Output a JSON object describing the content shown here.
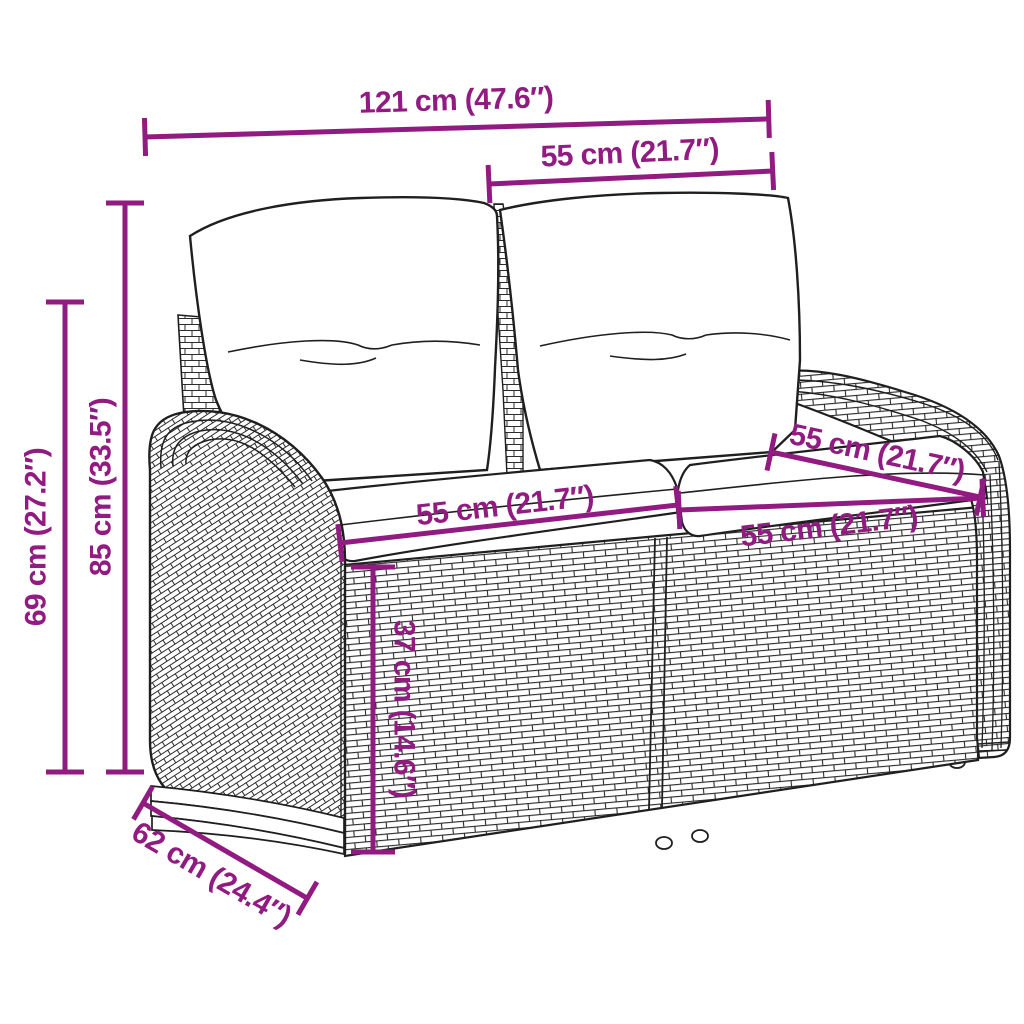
{
  "accent_color": "#911B80",
  "line_color": "#1f1f1f",
  "figure": {
    "subject": "garden-bench-line-drawing"
  },
  "dimensions": {
    "overall_width": "121 cm (47.6″)",
    "backrest_width": "55 cm (21.7″)",
    "total_height": "85 cm (33.5″)",
    "arm_height": "69 cm (27.2″)",
    "seat_width_left": "55 cm (21.7″)",
    "seat_width_right": "55 cm (21.7″)",
    "seat_depth": "55 cm (21.7″)",
    "seat_height": "37 cm (14.6″)",
    "overall_depth": "62 cm (24.4″)"
  }
}
